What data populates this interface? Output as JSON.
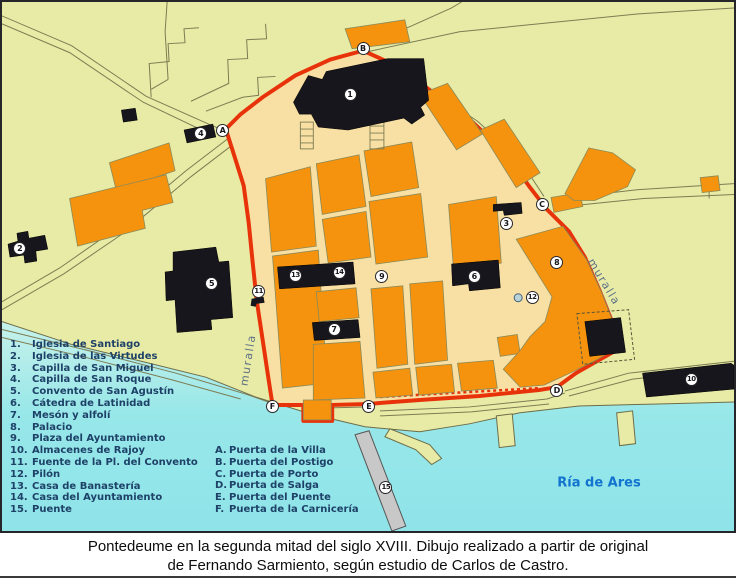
{
  "map": {
    "labels": {
      "water_name": "Ría de Ares",
      "wall_label_left": "muralla",
      "wall_label_right": "muralla"
    },
    "markers_numbered": [
      {
        "label": "1",
        "x": 350,
        "y": 93
      },
      {
        "label": "2",
        "x": 18,
        "y": 248
      },
      {
        "label": "3",
        "x": 507,
        "y": 223
      },
      {
        "label": "4",
        "x": 200,
        "y": 132
      },
      {
        "label": "5",
        "x": 211,
        "y": 284
      },
      {
        "label": "6",
        "x": 475,
        "y": 277
      },
      {
        "label": "7",
        "x": 334,
        "y": 330
      },
      {
        "label": "8",
        "x": 558,
        "y": 262
      },
      {
        "label": "9",
        "x": 382,
        "y": 277
      },
      {
        "label": "10",
        "x": 693,
        "y": 380
      },
      {
        "label": "11",
        "x": 258,
        "y": 292
      },
      {
        "label": "12",
        "x": 533,
        "y": 298
      },
      {
        "label": "13",
        "x": 295,
        "y": 276
      },
      {
        "label": "14",
        "x": 339,
        "y": 273
      },
      {
        "label": "15",
        "x": 386,
        "y": 489
      }
    ],
    "markers_gates": [
      {
        "label": "A",
        "x": 222,
        "y": 129
      },
      {
        "label": "B",
        "x": 363,
        "y": 47
      },
      {
        "label": "C",
        "x": 543,
        "y": 204
      },
      {
        "label": "D",
        "x": 558,
        "y": 391
      },
      {
        "label": "E",
        "x": 369,
        "y": 408
      },
      {
        "label": "F",
        "x": 272,
        "y": 408
      }
    ]
  },
  "legend": {
    "numbered": [
      {
        "num": "1.",
        "label": "Iglesia de Santiago"
      },
      {
        "num": "2.",
        "label": "Iglesia de las Virtudes"
      },
      {
        "num": "3.",
        "label": "Capilla de San Miguel"
      },
      {
        "num": "4.",
        "label": "Capilla de San Roque"
      },
      {
        "num": "5.",
        "label": "Convento de San Agustín"
      },
      {
        "num": "6.",
        "label": "Cátedra de Latinidad"
      },
      {
        "num": "7.",
        "label": "Mesón y alfolí"
      },
      {
        "num": "8.",
        "label": "Palacio"
      },
      {
        "num": "9.",
        "label": "Plaza del Ayuntamiento"
      },
      {
        "num": "10.",
        "label": "Almacenes de Rajoy"
      },
      {
        "num": "11.",
        "label": "Fuente de la Pl. del Convento"
      },
      {
        "num": "12.",
        "label": "Pilón"
      },
      {
        "num": "13.",
        "label": "Casa de Banastería"
      },
      {
        "num": "14.",
        "label": "Casa del Ayuntamiento"
      },
      {
        "num": "15.",
        "label": "Puente"
      }
    ],
    "lettered": [
      {
        "num": "A.",
        "label": "Puerta de la Villa"
      },
      {
        "num": "B.",
        "label": "Puerta del Postigo"
      },
      {
        "num": "C.",
        "label": "Puerta de Porto"
      },
      {
        "num": "D.",
        "label": "Puerta de Salga"
      },
      {
        "num": "E.",
        "label": "Puerta del Puente"
      },
      {
        "num": "F.",
        "label": "Puerta de la Carnicería"
      }
    ]
  },
  "caption": {
    "line1": "Pontedeume en la segunda mitad del siglo XVIII. Dibujo realizado a partir de original",
    "line2": "de Fernando Sarmiento, según estudio de Carlos de Castro."
  },
  "colors": {
    "land": "#e8eba6",
    "town_interior": "#f8dfa4",
    "urban_block_orange": "#f5930e",
    "landmark_black": "#16161c",
    "wall_red": "#e8330a",
    "water_shallow": "#c6f1ea",
    "water_deep": "#8fe4e9",
    "legend_text": "#1e4168",
    "water_label": "#1274cf",
    "wall_label": "#5d6f86"
  }
}
